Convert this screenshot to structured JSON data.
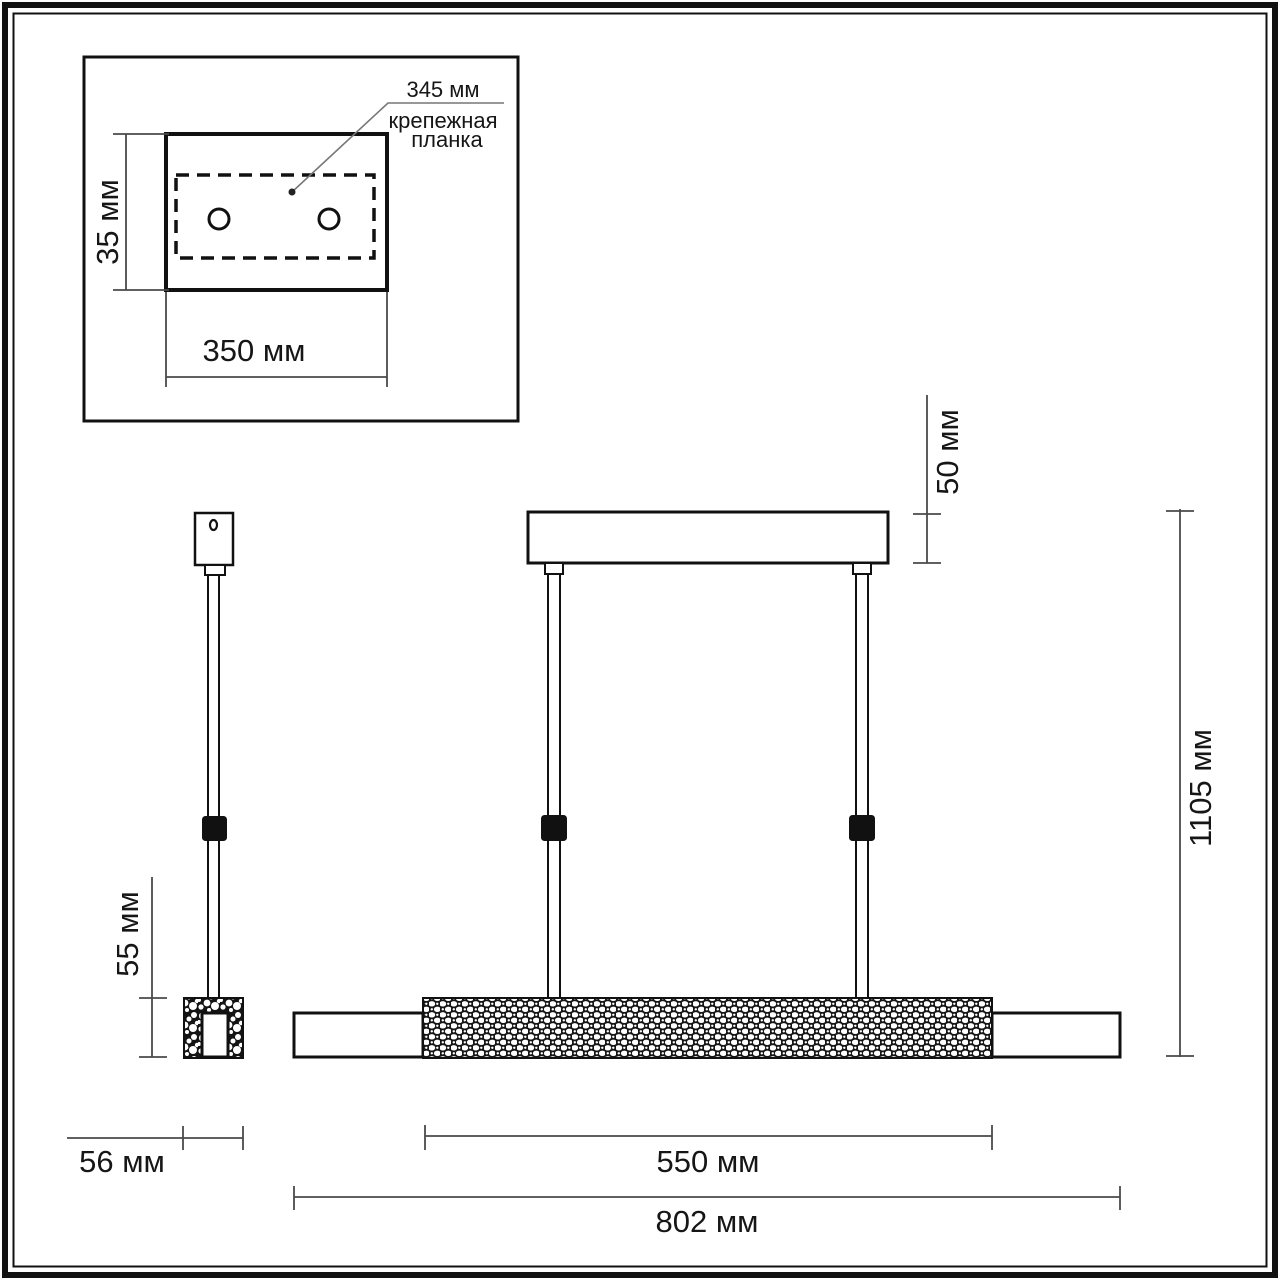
{
  "colors": {
    "ink": "#111111",
    "dim": "#4a4a4a",
    "paper": "#ffffff",
    "leader": "#777777"
  },
  "inset": {
    "plate_offset_label": "345 мм",
    "leader_word1": "крепежная",
    "leader_word2": "планка",
    "plate_height_label": "35 мм",
    "plate_width_label": "350 мм"
  },
  "side_view": {
    "end_cap_height_label": "55 мм",
    "end_cap_width_label": "56 мм"
  },
  "front_view": {
    "canopy_height_label": "50 мм",
    "overall_height_label": "1105 мм",
    "crystal_section_length_label": "550 мм",
    "overall_length_label": "802 мм"
  }
}
